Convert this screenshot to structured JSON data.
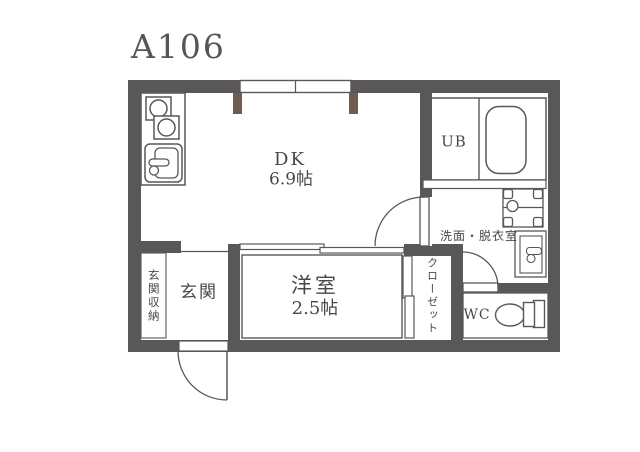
{
  "title": "A106",
  "colors": {
    "wall": "#595757",
    "pillar": "#6e5b51",
    "text": "#4a4848",
    "title_text": "#565454",
    "background": "#ffffff"
  },
  "rooms": {
    "dk": {
      "label": "DK",
      "size": "6.9帖"
    },
    "youshitsu": {
      "label": "洋室",
      "size": "2.5帖"
    },
    "genkan": {
      "label": "玄関"
    },
    "genkan_shunou": {
      "label": "玄関収納"
    },
    "ub": {
      "label": "UB"
    },
    "senmen": {
      "label": "洗面・脱衣室"
    },
    "wc": {
      "label": "WC"
    },
    "closet": {
      "label": "クローゼット"
    }
  },
  "icons": {
    "stove": "stove-burners-icon",
    "sink": "kitchen-sink-icon",
    "bathtub": "bathtub-icon",
    "washer_pan": "washing-machine-pan-icon",
    "washbasin": "washbasin-icon",
    "toilet": "toilet-icon",
    "entry_door": "swing-door-arc",
    "window": "double-pane-window",
    "sliding_door": "sliding-door-panels"
  }
}
